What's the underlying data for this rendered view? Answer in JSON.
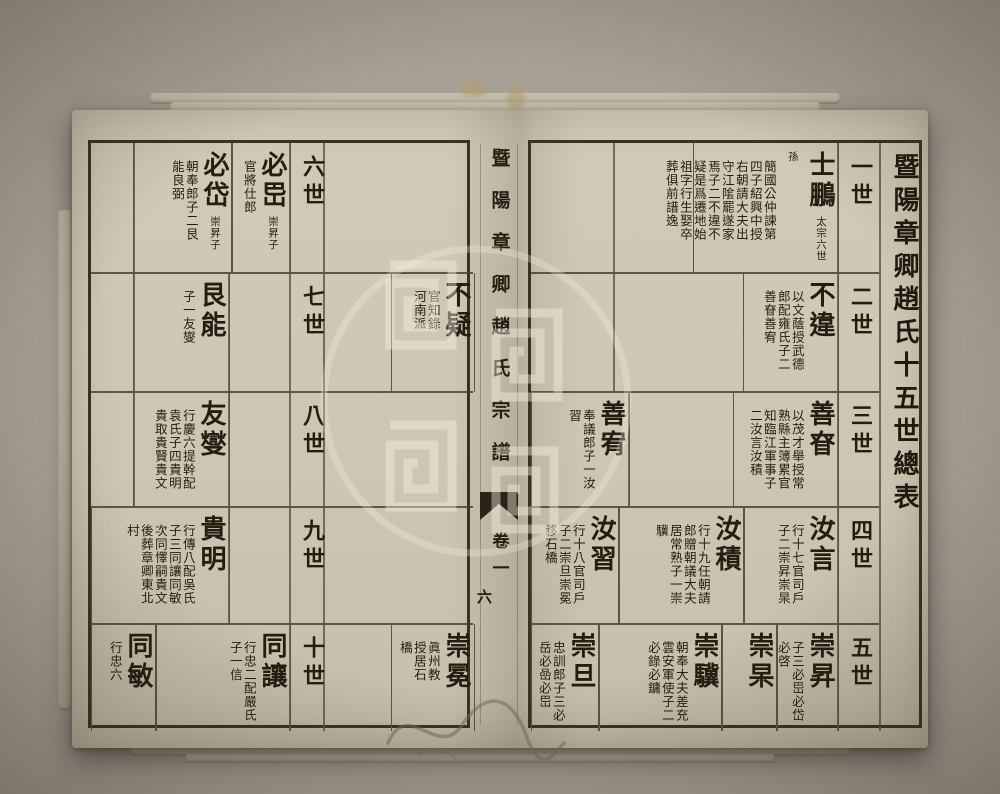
{
  "spine": {
    "title": "暨陽章卿趙氏宗譜",
    "volume": "卷一",
    "page_number": "六"
  },
  "right_page": {
    "table_title": "暨陽章卿趙氏十五世總表",
    "rows": [
      {
        "generation": "一世",
        "cells": [
          {
            "name": "士鵬",
            "side": "太宗六世孫",
            "ann": "簡國公仲諫第四子紹興中授右朝請大夫出守江隂罷遂家焉子二不違不疑是爲遷地始祖字行生娶卒葬俱前譜逸"
          }
        ]
      },
      {
        "generation": "二世",
        "cells": [
          {
            "name": "不違",
            "side": "",
            "ann": "以文蔭授武德郎配雍氏子二善眘善宥"
          }
        ]
      },
      {
        "generation": "三世",
        "cells": [
          {
            "name": "善眘",
            "side": "",
            "ann": "以茂才舉授常熟縣主簿累官知臨江軍事子二汝言汝積"
          },
          {
            "name": "善宥",
            "side": "",
            "ann": "奉議郎子一汝習"
          }
        ]
      },
      {
        "generation": "四世",
        "cells": [
          {
            "name": "汝言",
            "side": "",
            "ann": "行十七官司戶子二崇昇崇杲"
          },
          {
            "name": "汝積",
            "side": "",
            "ann": "行十九任朝請郎贈朝議大夫居常熟子一崇驥"
          },
          {
            "name": "汝習",
            "side": "",
            "ann": "行十八官司戶子二崇旦崇冕移石橋"
          }
        ]
      },
      {
        "generation": "五世",
        "cells": [
          {
            "name": "崇昇",
            "side": "",
            "ann": "子三必岊必岱必啓"
          },
          {
            "name": "崇杲",
            "side": "",
            "ann": ""
          },
          {
            "name": "崇驥",
            "side": "",
            "ann": "朝奉大夫差充雲安軍使子二必錄必鏞"
          },
          {
            "name": "崇旦",
            "side": "",
            "ann": "忠訓郎子三必岳必嵒必岊"
          }
        ]
      }
    ]
  },
  "left_page": {
    "rows": [
      {
        "generation": "六世",
        "cells": [
          {
            "name": "必岊",
            "side": "崇昇子",
            "ann": "官將仕郎"
          },
          {
            "name": "必岱",
            "side": "崇昇子",
            "ann": "朝奉郎子二艮能良弼"
          }
        ]
      },
      {
        "generation": "七世",
        "cells": [
          {
            "name": "艮能",
            "side": "",
            "ann": "子一友燮"
          }
        ]
      },
      {
        "generation": "八世",
        "cells": [
          {
            "name": "友燮",
            "side": "",
            "ann": "行慶六提幹配袁氏子四貴明貴取貴賢貴文"
          }
        ]
      },
      {
        "generation": "九世",
        "cells": [
          {
            "name": "貴明",
            "side": "",
            "ann": "行傳八配吳氏子三同讓同敏次同懌嗣貴文後葬章卿東北村"
          }
        ]
      },
      {
        "generation": "十世",
        "cells": [
          {
            "name": "同讓",
            "side": "",
            "ann": "行忠二配嚴氏子一信"
          },
          {
            "name": "同敏",
            "side": "",
            "ann": "行忠六"
          }
        ]
      }
    ],
    "continuation_cells": [
      {
        "name": "不疑",
        "ann": "官知錄河南派",
        "aligns_with_generation": "二世"
      },
      {
        "name": "崇冕",
        "ann": "眞州教授居石橋",
        "aligns_with_generation": "五世"
      }
    ]
  },
  "colors": {
    "paper": "#cfc8b5",
    "ink": "#241d12",
    "grid_line": "#5c5342",
    "background": "#a8a195"
  }
}
